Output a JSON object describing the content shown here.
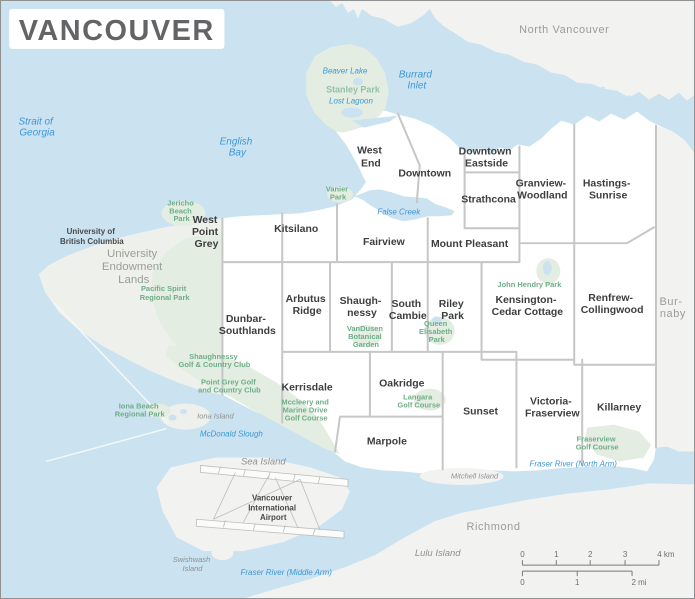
{
  "title": "VANCOUVER",
  "colors": {
    "water": "#cbe2f0",
    "city": "#ffffff",
    "other": "#f2f2f0",
    "uel": "#eef1eb",
    "park": "#e3ede1",
    "border": "#c6c6c6",
    "title": "#636466",
    "hood": "#3d3e3f",
    "town": "#9a9b9d",
    "island": "#8e9092",
    "waterlabel": "#3e97d4",
    "parklabel": "#6fae88",
    "stanleylabel": "#93c1a4"
  },
  "towns": {
    "north_vancouver": "North Vancouver",
    "burnaby_l1": "Bur-",
    "burnaby_l2": "naby",
    "richmond": "Richmond"
  },
  "areas": {
    "uel_l1": "University",
    "uel_l2": "Endowment",
    "uel_l3": "Lands",
    "ubc_l1": "University of",
    "ubc_l2": "British Columbia",
    "airport_l1": "Vancouver",
    "airport_l2": "International",
    "airport_l3": "Airport"
  },
  "neighborhoods": {
    "west_end_l1": "West",
    "west_end_l2": "End",
    "downtown": "Downtown",
    "dtes_l1": "Downtown",
    "dtes_l2": "Eastside",
    "strathcona": "Strathcona",
    "grandview_l1": "Granview-",
    "grandview_l2": "Woodland",
    "hastings_l1": "Hastings-",
    "hastings_l2": "Sunrise",
    "wpg_l1": "West",
    "wpg_l2": "Point",
    "wpg_l3": "Grey",
    "kitsilano": "Kitsilano",
    "fairview": "Fairview",
    "mount_pleasant": "Mount Pleasant",
    "arbutus_l1": "Arbutus",
    "arbutus_l2": "Ridge",
    "shaughnessy_l1": "Shaugh-",
    "shaughnessy_l2": "nessy",
    "south_cambie_l1": "South",
    "south_cambie_l2": "Cambie",
    "riley_l1": "Riley",
    "riley_l2": "Park",
    "kensington_l1": "Kensington-",
    "kensington_l2": "Cedar Cottage",
    "renfrew_l1": "Renfrew-",
    "renfrew_l2": "Collingwood",
    "dunbar_l1": "Dunbar-",
    "dunbar_l2": "Southlands",
    "kerrisdale": "Kerrisdale",
    "oakridge": "Oakridge",
    "marpole": "Marpole",
    "sunset": "Sunset",
    "victoria_l1": "Victoria-",
    "victoria_l2": "Fraserview",
    "killarney": "Killarney"
  },
  "water": {
    "strait_l1": "Strait of",
    "strait_l2": "Georgia",
    "english_bay_l1": "English",
    "english_bay_l2": "Bay",
    "burrard_l1": "Burrard",
    "burrard_l2": "Inlet",
    "false_creek": "False Creek",
    "beaver_lake": "Beaver Lake",
    "lost_lagoon": "Lost Lagoon",
    "mcdonald_slough": "McDonald Slough",
    "fraser_north": "Fraser River (North Arm)",
    "fraser_middle": "Fraser River (Middle Arm)"
  },
  "parks": {
    "stanley": "Stanley Park",
    "jericho_l1": "Jericho",
    "jericho_l2": "Beach",
    "jericho_l3": "Park",
    "vanier_l1": "Vanier",
    "vanier_l2": "Park",
    "pacific_l1": "Pacific Spirit",
    "pacific_l2": "Regional Park",
    "qe_l1": "Queen",
    "qe_l2": "Elisabeth",
    "qe_l3": "Park",
    "john_hendry": "John Hendry Park",
    "vandusen_l1": "VanDusen",
    "vandusen_l2": "Botanical",
    "vandusen_l3": "Garden",
    "shaughnessy_gc_l1": "Shaughnessy",
    "shaughnessy_gc_l2": "Golf & Country Club",
    "point_grey_gc_l1": "Point Grey Golf",
    "point_grey_gc_l2": "and Country Club",
    "mccleery_l1": "Mccleery and",
    "mccleery_l2": "Marine Drive",
    "mccleery_l3": "Golf Course",
    "langara_l1": "Langara",
    "langara_l2": "Golf Course",
    "fraserview_gc_l1": "Fraserview",
    "fraserview_gc_l2": "Golf Course",
    "iona_beach_l1": "Iona Beach",
    "iona_beach_l2": "Regional Park"
  },
  "islands": {
    "sea": "Sea Island",
    "iona": "Iona Island",
    "mitchell": "Mitchell Island",
    "swishwash_l1": "Swishwash",
    "swishwash_l2": "Island",
    "lulu": "Lulu Island"
  },
  "scale": {
    "km": [
      "0",
      "1",
      "2",
      "3",
      "4 km"
    ],
    "mi": [
      "0",
      "1",
      "2 mi"
    ]
  }
}
